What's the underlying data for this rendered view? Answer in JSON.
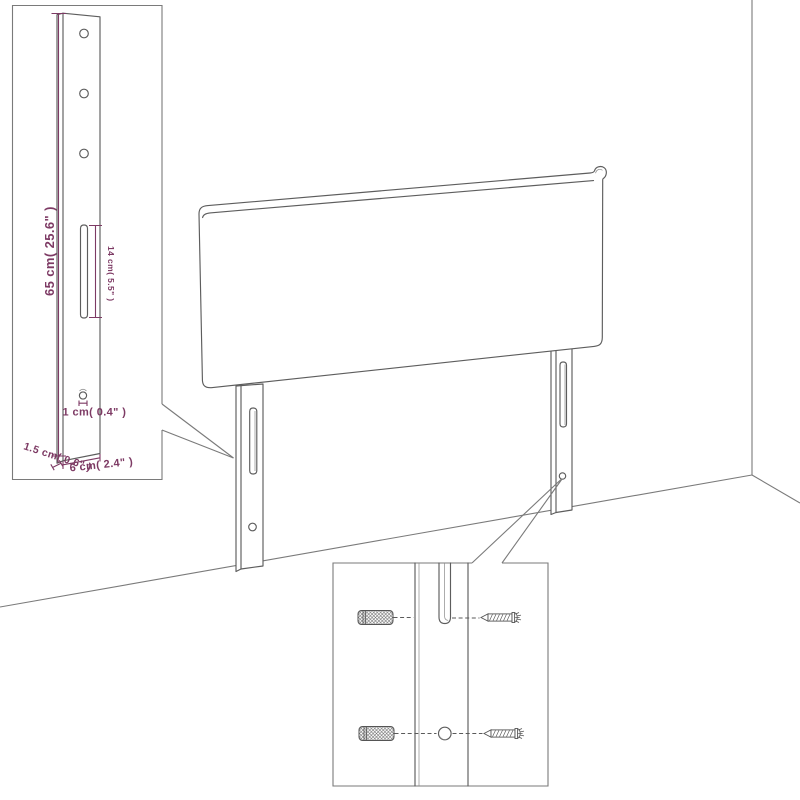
{
  "diagram": {
    "background_color": "#ffffff",
    "line_color": "#5d5d5d",
    "frame_color": "#7a7a7a",
    "dimension_color": "#7d3a64",
    "leg_detail_inset": {
      "labels": {
        "height": "65 cm( 25.6\" )",
        "slot_length": "14 cm( 5.5\" )",
        "hole_diameter": "1 cm( 0.4\" )",
        "thickness": "1.5 cm( 0.6\" )",
        "width": "6 cm( 2.4\" )"
      }
    },
    "mounting_detail_inset": {
      "icons": {
        "left_top": "wall-plug-icon",
        "left_bottom": "wall-plug-icon",
        "right_top": "screw-icon",
        "right_bottom": "screw-icon"
      }
    }
  }
}
